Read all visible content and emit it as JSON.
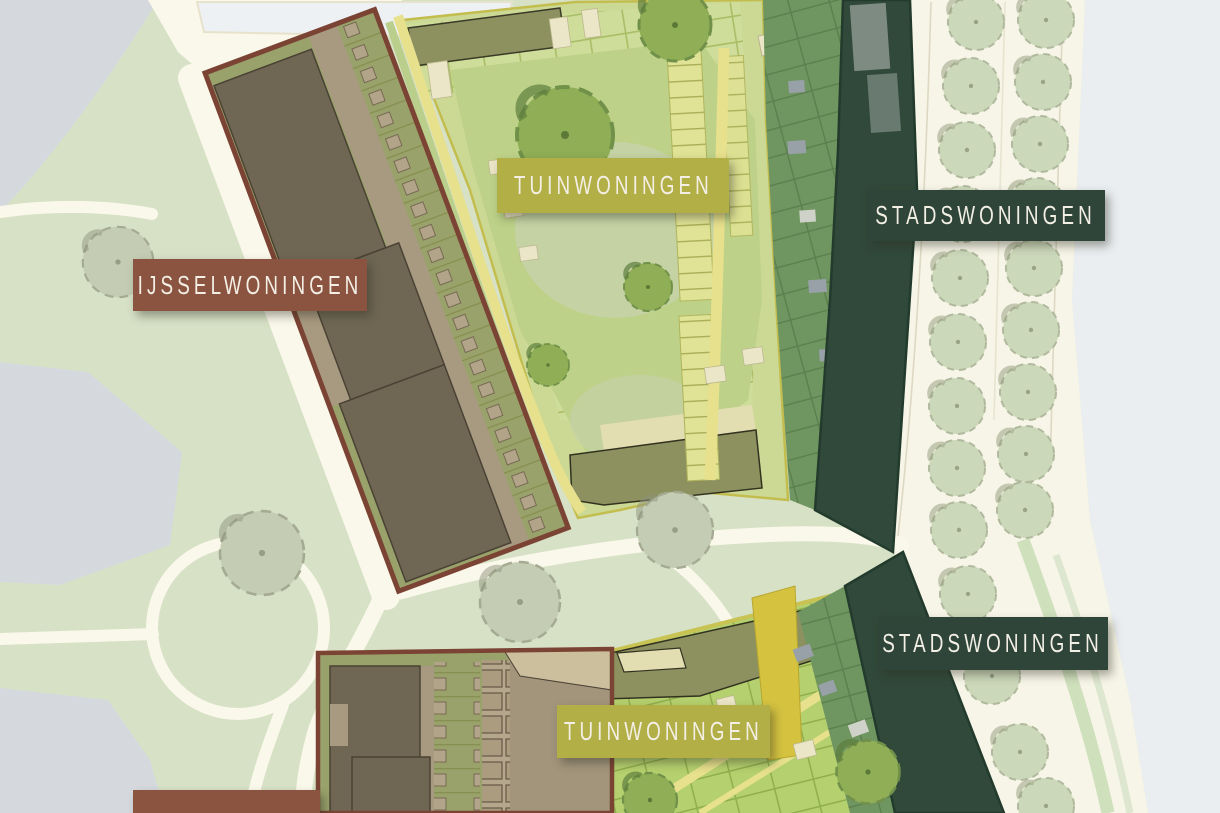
{
  "map": {
    "description": "Site plan of a housing development with three dwelling types",
    "type_labels": {
      "ijsselwoningen": {
        "text": "IJSSELWONINGEN",
        "color": "#8b5441"
      },
      "tuinwoningen_top": {
        "text": "TUINWONINGEN",
        "color": "#b2af47"
      },
      "stadswoningen_top": {
        "text": "STADSWONINGEN",
        "color": "#2f453a"
      },
      "stadswoningen_bottom": {
        "text": "STADSWONINGEN",
        "color": "#2f453a"
      },
      "tuinwoningen_bottom": {
        "text": "TUINWONINGEN",
        "color": "#b2af47"
      }
    },
    "palette": {
      "park_green": "#d7e1c6",
      "path_cream": "#faf8ea",
      "water_gray": "#eaeef1",
      "paved_gray": "#d5d9de",
      "ijssel_block_border": "#7b4334",
      "tuin_border_yellow": "#c8c353",
      "stads_building_green": "#31493a",
      "garden_strip_green": "#6f9560",
      "street_tree_sage": "#ccd8ba"
    }
  }
}
